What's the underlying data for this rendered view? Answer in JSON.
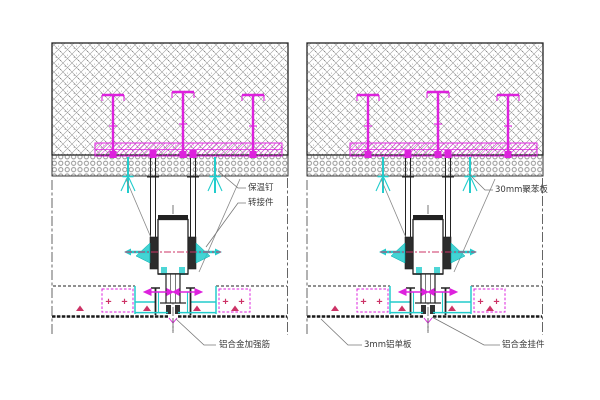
{
  "page": {
    "background": "#ffffff",
    "description": "Two section details of an aluminum panel suspended soffit fixed to a concrete slab"
  },
  "drawing": {
    "labels": {
      "insulation_nail": "保温钉",
      "adapter_piece": "转接件",
      "polystyrene_board": "30mm聚苯板",
      "stiffener": "铝合金加强筋",
      "aluminum_panel": "3mm铝单板",
      "hanger_piece": "铝合金挂件",
      "stiffener_marks": "+ +"
    },
    "colors": {
      "anchor_magenta": "#dd22dd",
      "accent_crimson": "#cc3366",
      "fitting_cyan": "#22cccc",
      "line_black": "#222222",
      "hatch_gray": "#909090",
      "leader_gray": "#777777"
    }
  }
}
